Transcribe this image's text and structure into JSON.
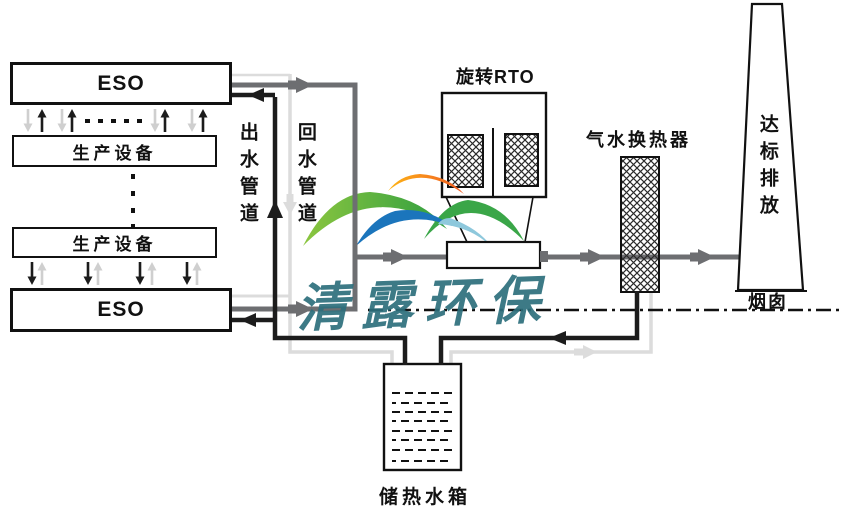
{
  "colors": {
    "pipe_hot": "#1c1c1c",
    "pipe_flue": "#6d6e71",
    "pipe_cold": "#dcdcdc",
    "arrow_faint": "#cfcfcf",
    "watermark_teal": "#2d6f7c",
    "logo_orange_light": "#fdb515",
    "logo_orange": "#f15a24",
    "logo_green_light": "#8cc63f",
    "logo_green": "#2f9e41",
    "logo_green_mid": "#3aa648",
    "logo_blue": "#1b75bc",
    "logo_blue_light": "#8ec8dc"
  },
  "equipment": {
    "eso_top": "ESO",
    "production_top": "生产设备",
    "production_bottom": "生产设备",
    "eso_bottom": "ESO",
    "rto": "旋转RTO",
    "heat_exchanger": "气水换热器",
    "stack_emission": "达标排放",
    "stack": "烟囱",
    "tank": "储热水箱"
  },
  "pipes": {
    "outlet": "出水管道",
    "return": "回水管道"
  },
  "watermark": {
    "text": "清露环保"
  }
}
